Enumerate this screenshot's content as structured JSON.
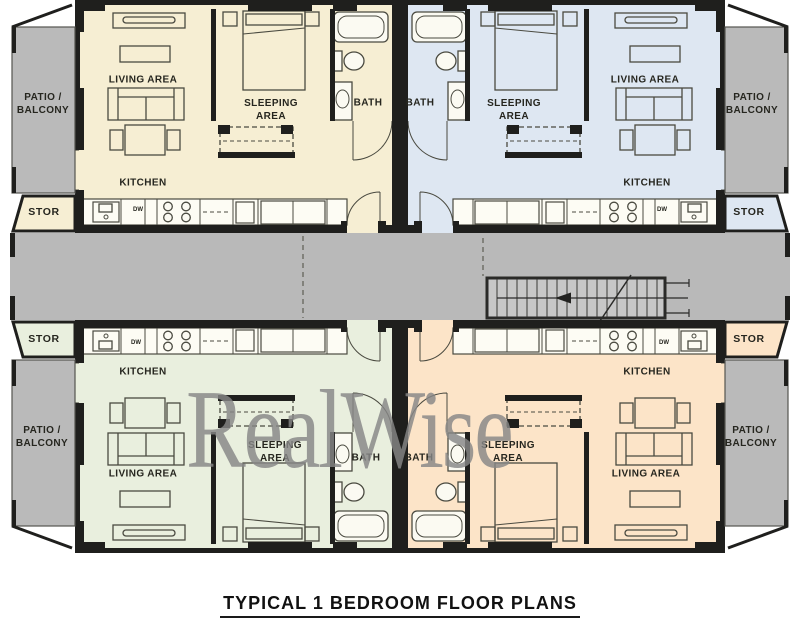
{
  "title": "TYPICAL 1 BEDROOM FLOOR PLANS",
  "watermark": "RealWise",
  "rooms": {
    "living": "LIVING AREA",
    "sleeping": "SLEEPING\nAREA",
    "bath": "BATH",
    "kitchen": "KITCHEN",
    "dishwasher": "DW",
    "storage": "STOR",
    "patio": "PATIO /\nBALCONY"
  },
  "units": [
    {
      "name": "top-left",
      "color": "#f6eed3"
    },
    {
      "name": "top-right",
      "color": "#dee7f2"
    },
    {
      "name": "bottom-left",
      "color": "#e9efde"
    },
    {
      "name": "bottom-right",
      "color": "#fce4c8"
    }
  ],
  "colors": {
    "corridor": "#b9b9b9",
    "patio": "#bababa",
    "stairs": "#c7c7c7",
    "wall": "#1f1f1d"
  }
}
